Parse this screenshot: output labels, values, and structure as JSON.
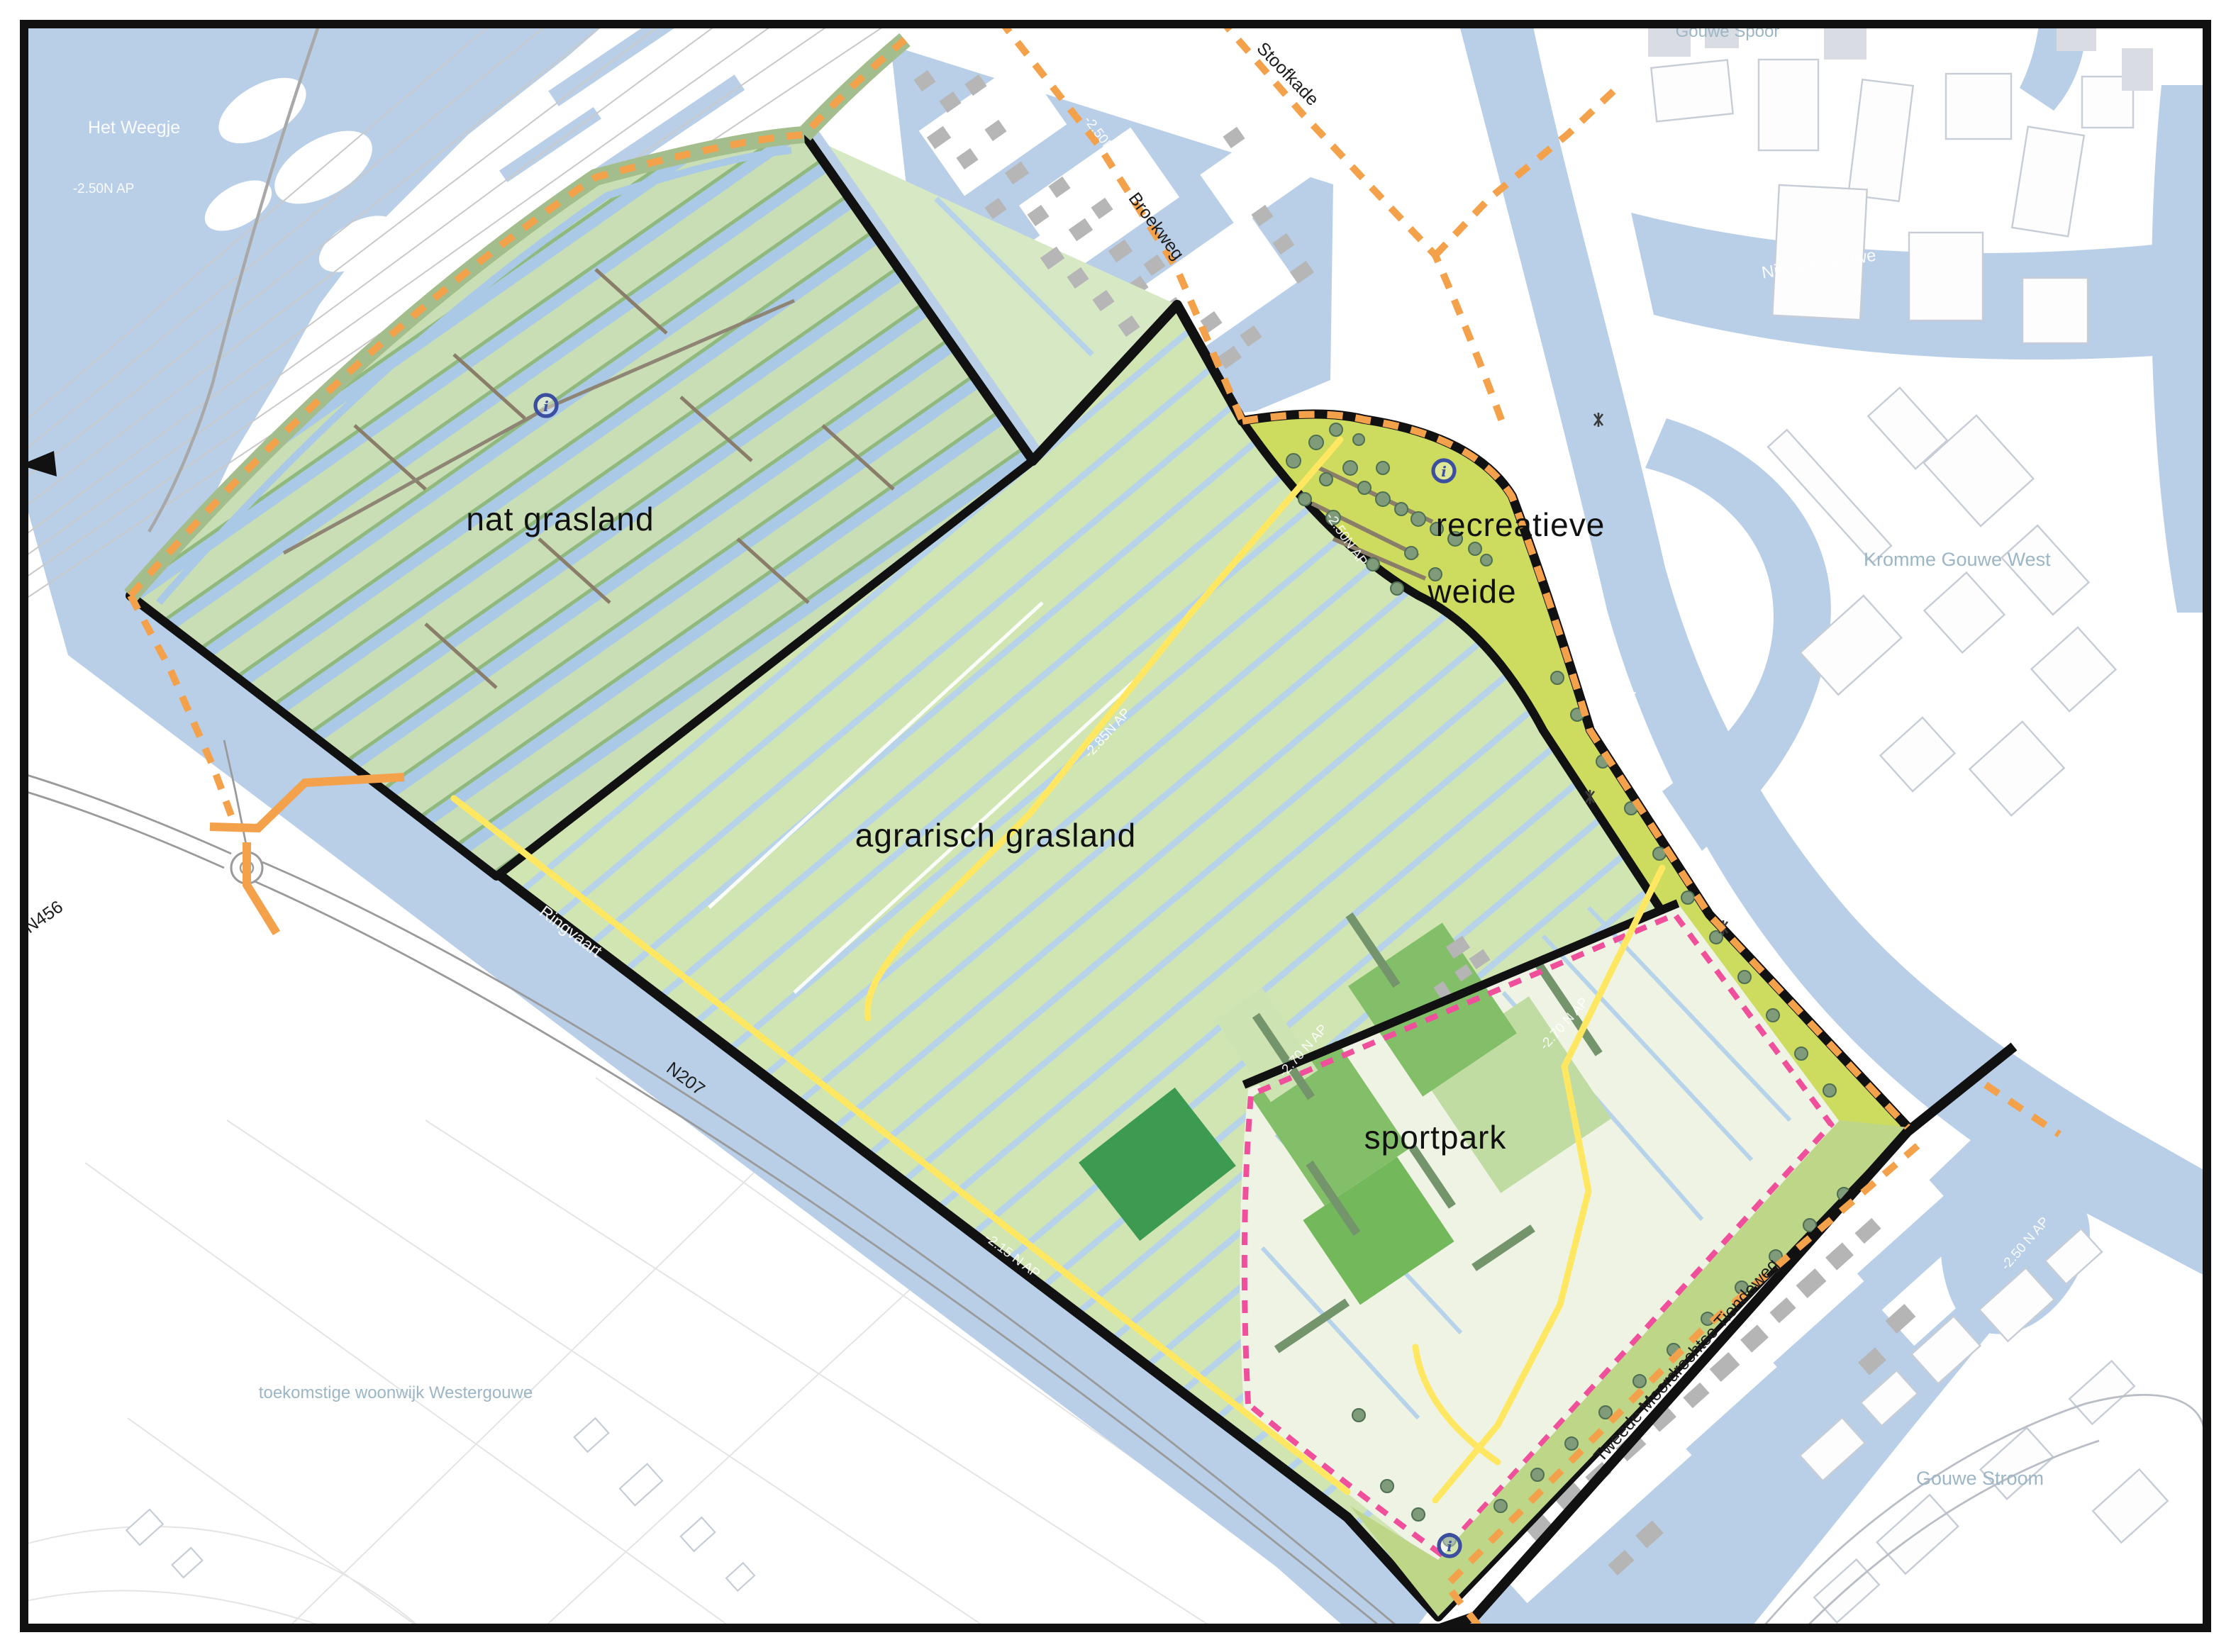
{
  "map": {
    "zone_labels": {
      "nat": "nat grasland",
      "agrarisch": "agrarisch grasland",
      "recreatieve_line1": "recreatieve",
      "recreatieve_line2": "weide",
      "sportpark": "sportpark"
    },
    "place_labels": {
      "het_weegje": "Het Weegje",
      "gouwe_spoor": "Gouwe Spoor",
      "nieuwe_gouwe": "Nieuwe Gouwe",
      "kromme_gouwe_west": "Kromme Gouwe West",
      "gouwekanaal": "Gouwekanaal",
      "ringvaart": "Ringvaart",
      "gouwe_stroom": "Gouwe Stroom",
      "westergouwe": "toekomstige woonwijk Westergouwe"
    },
    "road_labels": {
      "stoofkade": "Stoofkade",
      "broekweg": "Broekweg",
      "n456": "N456",
      "n207": "N207",
      "tiendeweg": "Tweede Moordrechtse Tiendeweg"
    },
    "elevation_labels": {
      "het_weegje": "-2.50N AP",
      "broekweg": "-2.50N AP",
      "weide_west": "-2.50N AP",
      "agrarisch": "-2.85N AP",
      "ringvaart": "-2.15 N AP",
      "sportpark_west": "-2.70 N AP",
      "sportpark_east": "-2.70 N AP",
      "gouwe_stroom": "-2.50 N AP"
    },
    "info_icon_glyph": "i",
    "colors": {
      "water": "#b9cfe8",
      "agrarisch_green": "#d0e5b2",
      "nat_green": "#c9deb5",
      "weide_green": "#cddc5f",
      "sport_field_green": "#83bf68",
      "sport_field_dark": "#3d9b51",
      "route_orange": "#f4a14c",
      "path_yellow": "#ffe761",
      "boundary_pink": "#ef4f9b",
      "boundary_black": "#111111",
      "info_blue": "#3b4ea0",
      "tree_green": "#7f9b79"
    }
  }
}
